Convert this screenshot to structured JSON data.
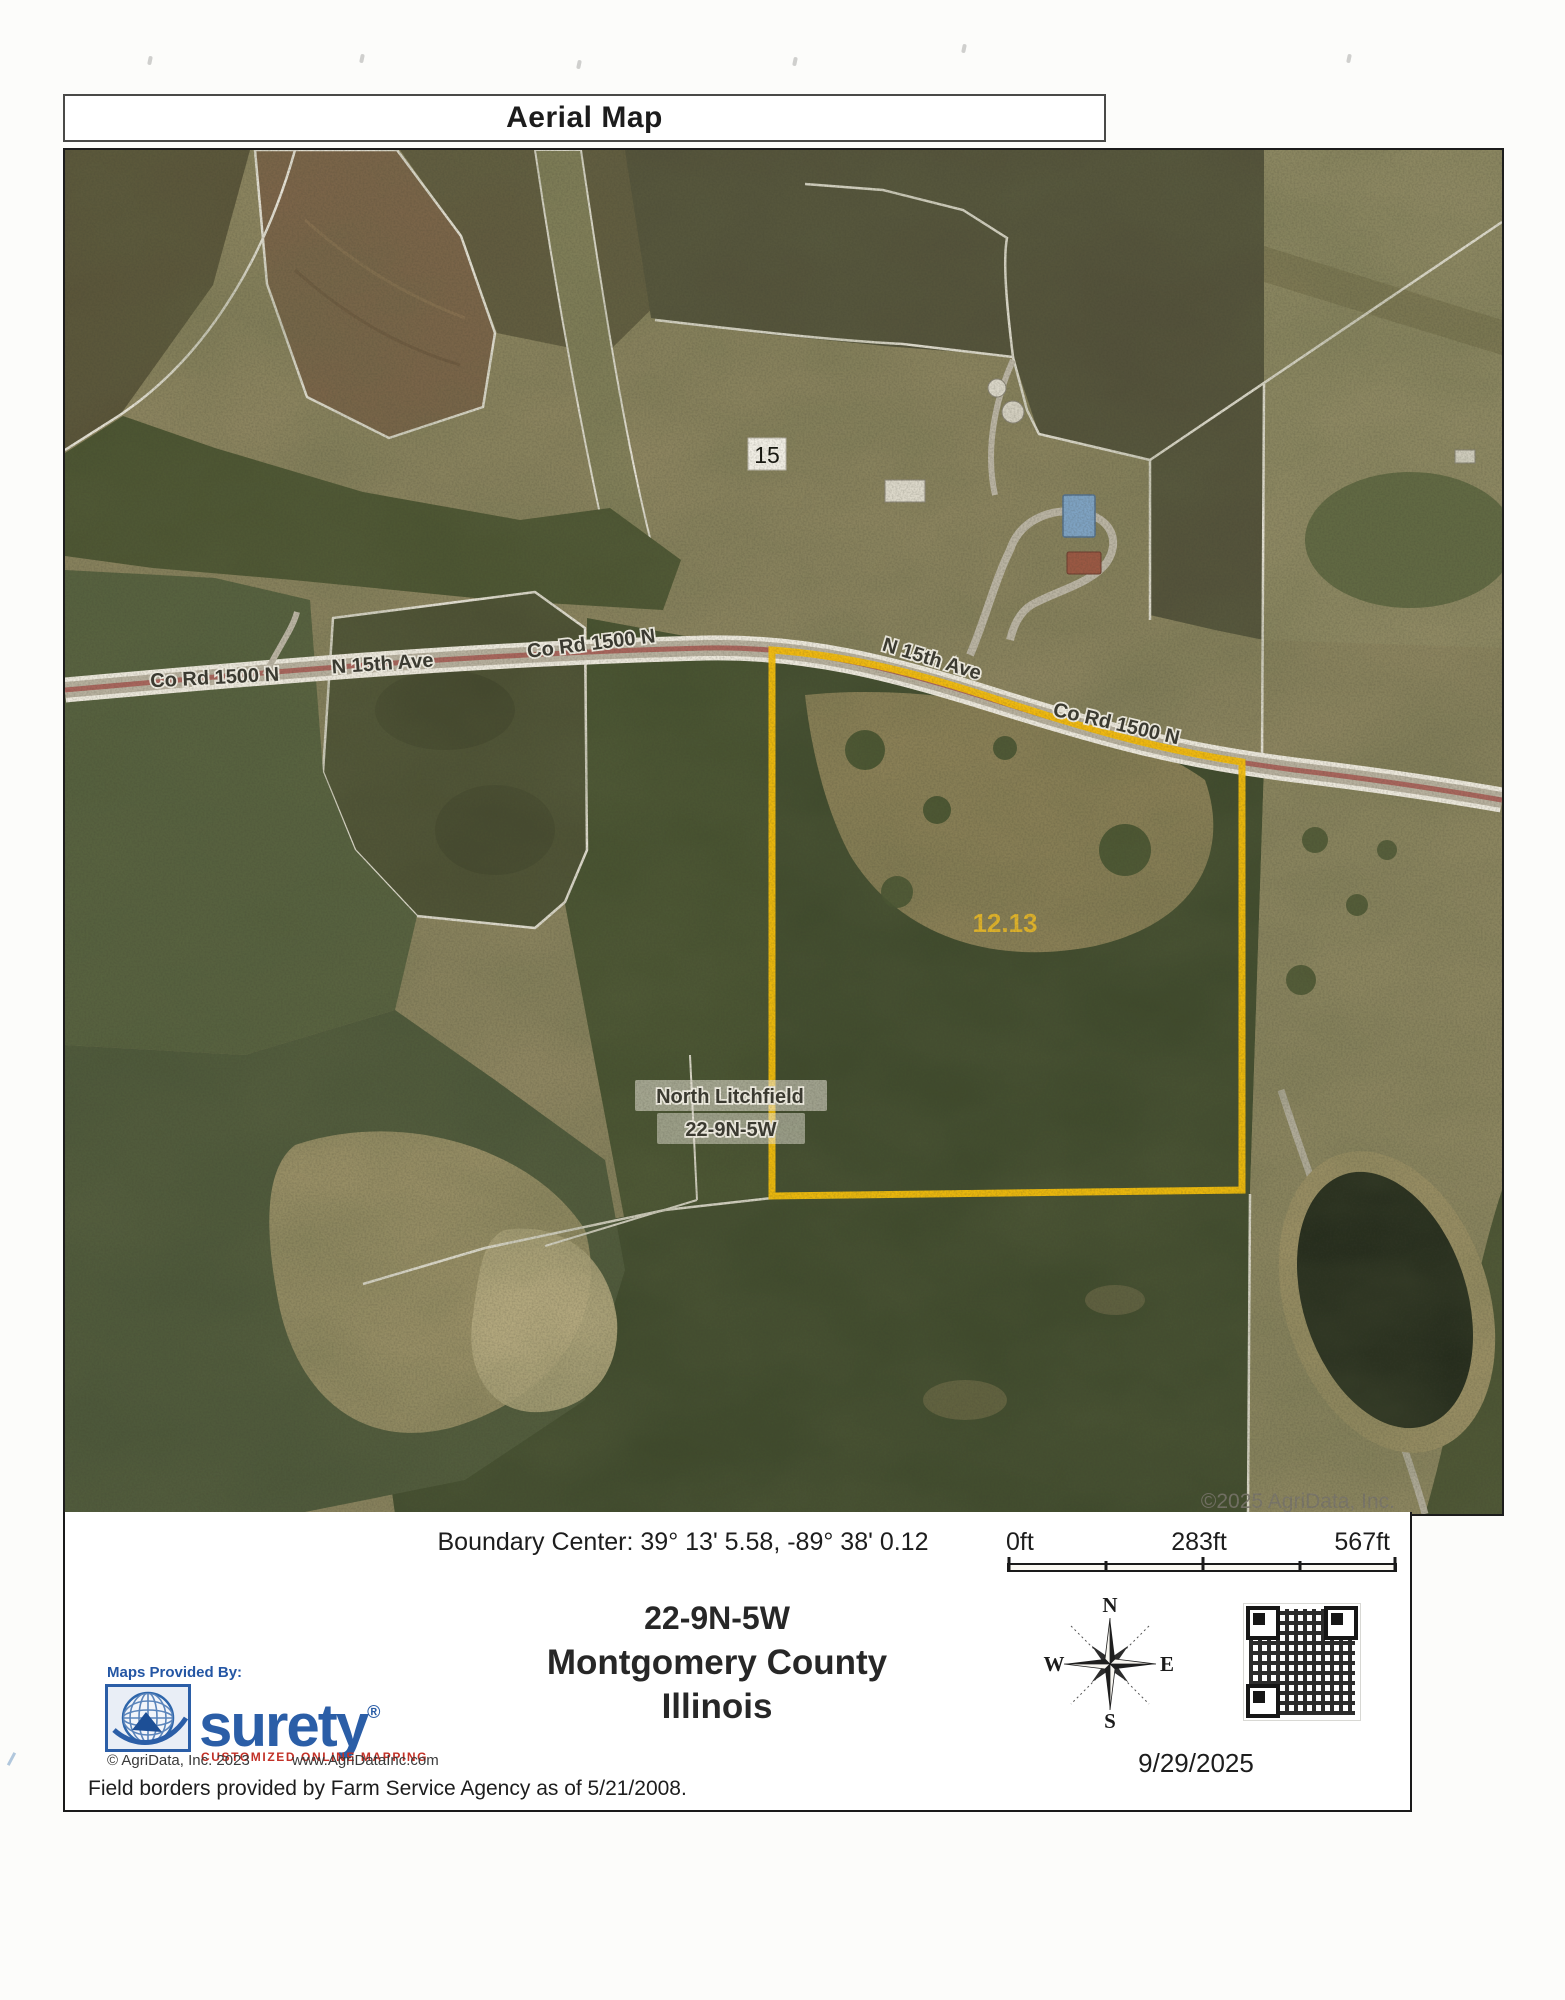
{
  "page": {
    "title": "Aerial Map"
  },
  "map": {
    "labels": {
      "road_left": "Co Rd 1500 N",
      "ave_left": "N 15th Ave",
      "road_mid": "Co Rd 1500 N",
      "ave_right": "N 15th Ave",
      "road_right": "Co Rd 1500 N",
      "section_marker": "15",
      "acreage": "12.13",
      "township": "North Litchfield",
      "township_section": "22-9N-5W",
      "watermark": "©2025 AgriData, Inc."
    },
    "boundary_color": "#f2bd0c"
  },
  "footer": {
    "boundary_center": "Boundary Center: 39° 13' 5.58, -89° 38' 0.12",
    "scale": {
      "start": "0ft",
      "mid": "283ft",
      "end": "567ft"
    },
    "location": {
      "section": "22-9N-5W",
      "county": "Montgomery County",
      "state": "Illinois"
    },
    "compass": {
      "n": "N",
      "s": "S",
      "e": "E",
      "w": "W"
    },
    "date": "9/29/2025",
    "provider": {
      "label": "Maps Provided By:",
      "brand": "surety",
      "registered": "®",
      "tagline": "CUSTOMIZED ONLINE MAPPING",
      "copyright": "© AgriData, Inc. 2023",
      "website": "www.AgriDataInc.com"
    },
    "disclaimer": "Field borders provided by Farm Service Agency as of 5/21/2008."
  }
}
